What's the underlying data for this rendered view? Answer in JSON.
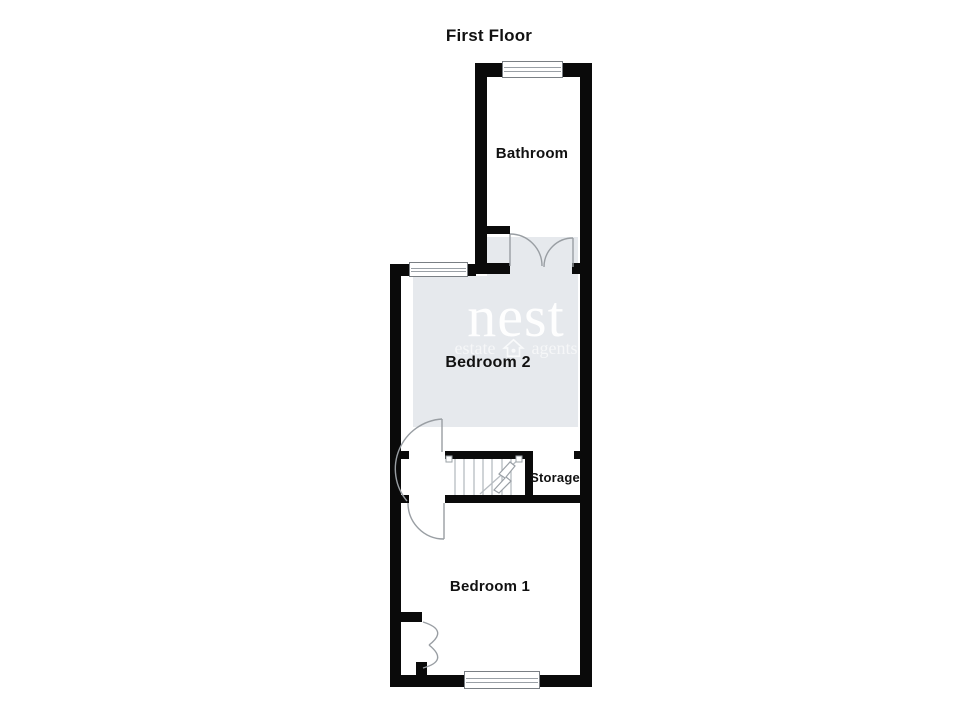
{
  "title": "First Floor",
  "rooms": {
    "bathroom": {
      "label": "Bathroom"
    },
    "bedroom2": {
      "label": "Bedroom 2"
    },
    "storage": {
      "label": "Storage"
    },
    "bedroom1": {
      "label": "Bedroom 1"
    }
  },
  "watermark": {
    "brand": "nest",
    "tagline_left": "estate",
    "tagline_right": "agents",
    "icon": "house-icon"
  },
  "colors": {
    "wall": "#0a0a0a",
    "background": "#ffffff",
    "watermark_box": "#e6e9ed",
    "door_arc": "#999ea3",
    "label_text": "#111111"
  }
}
